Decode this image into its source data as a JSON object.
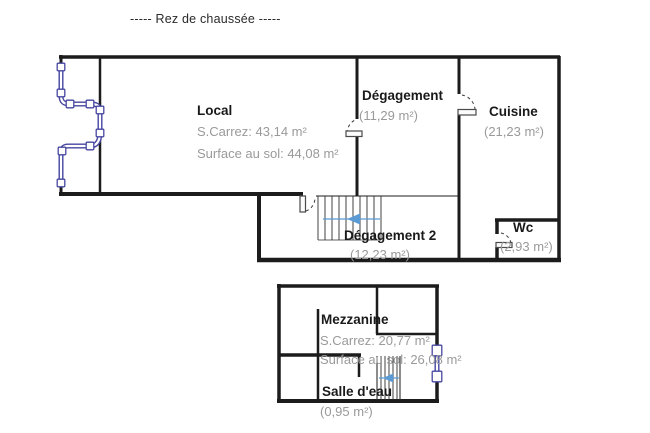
{
  "title": "-----  Rez de chaussée  -----",
  "colors": {
    "wall": "#1c1c1c",
    "room_text": "#1a1a1a",
    "area_text": "#9a9a9a",
    "window_symbol": "#4646a0",
    "stair_arrow": "#5b9bd5"
  },
  "rooms": {
    "local": {
      "name": "Local",
      "carrez": "S.Carrez: 43,14 m²",
      "floor": "Surface au sol: 44,08 m²"
    },
    "degagement": {
      "name": "Dégagement",
      "area": "(11,29 m²)"
    },
    "cuisine": {
      "name": "Cuisine",
      "area": "(21,23 m²)"
    },
    "degagement2": {
      "name": "Dégagement 2",
      "area": "(12,23 m²)"
    },
    "wc": {
      "name": "Wc",
      "area": "(2,93 m²)"
    },
    "mezzanine": {
      "name": "Mezzanine",
      "carrez": "S.Carrez: 20,77 m²",
      "floor": "Surface au sol: 26,08 m²"
    },
    "salle_deau": {
      "name": "Salle d'eau",
      "area": "(0,95 m²)"
    }
  }
}
